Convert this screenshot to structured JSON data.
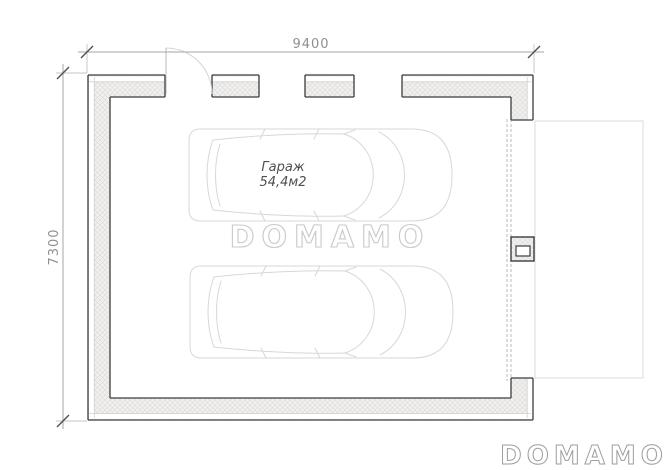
{
  "plan": {
    "room_name": "Гараж",
    "room_area": "54,4м2",
    "dimension_width": "9400",
    "dimension_height": "7300"
  },
  "watermark": {
    "center": "DOMAMO",
    "bottom_right": "DOMAMO"
  },
  "colors": {
    "wall_outline": "#3c3c3c",
    "wall_hatch_line": "#dcdbd9",
    "wall_hatch_bg": "#f1f0ef",
    "dimension_text": "#8f8f8f",
    "car_outline": "#d5d8da",
    "watermark_center": "#c9c9c9",
    "watermark_corner": "#9e9e9e"
  }
}
